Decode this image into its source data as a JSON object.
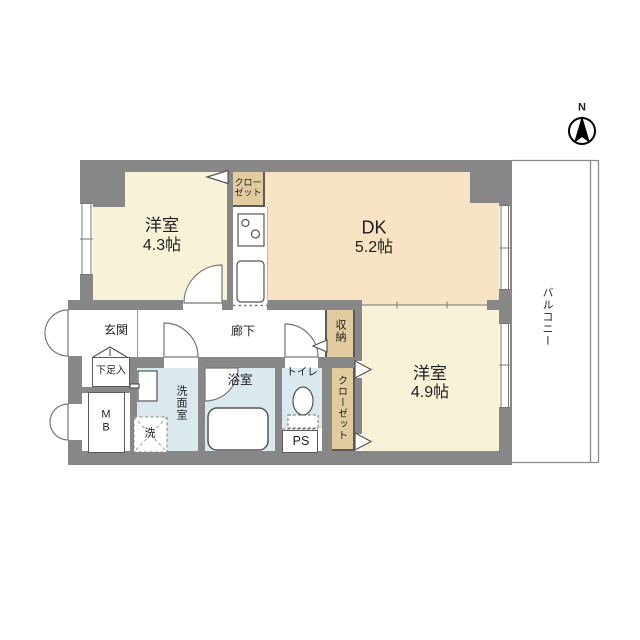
{
  "colors": {
    "wall": "#878787",
    "room_cream": "#f8f3d8",
    "dk_peach": "#f8e3c4",
    "closet_tan": "#e2cb9e",
    "wet_blue": "#d9e9ee",
    "line": "#777777",
    "text": "#1f1f1f"
  },
  "compass": {
    "north_label": "N"
  },
  "rooms": {
    "western_room_1": {
      "name": "洋室",
      "size": "4.3帖"
    },
    "dining_kitchen": {
      "name": "DK",
      "size": "5.2帖"
    },
    "western_room_2": {
      "name": "洋室",
      "size": "4.9帖"
    },
    "entrance": {
      "name": "玄関"
    },
    "hallway": {
      "name": "廊下"
    },
    "washroom": {
      "name": "洗面室"
    },
    "bathroom": {
      "name": "浴室"
    },
    "toilet": {
      "name": "トイレ"
    },
    "balcony": {
      "name": "バルコニー"
    }
  },
  "storage": {
    "closet_top": "クロー\nゼット",
    "closet_side": "クローゼット",
    "storage_unit": "収納",
    "shoe_cabinet": "下足入",
    "meter_box": "M\nB",
    "pipe_space": "PS",
    "washing_machine": "洗"
  }
}
